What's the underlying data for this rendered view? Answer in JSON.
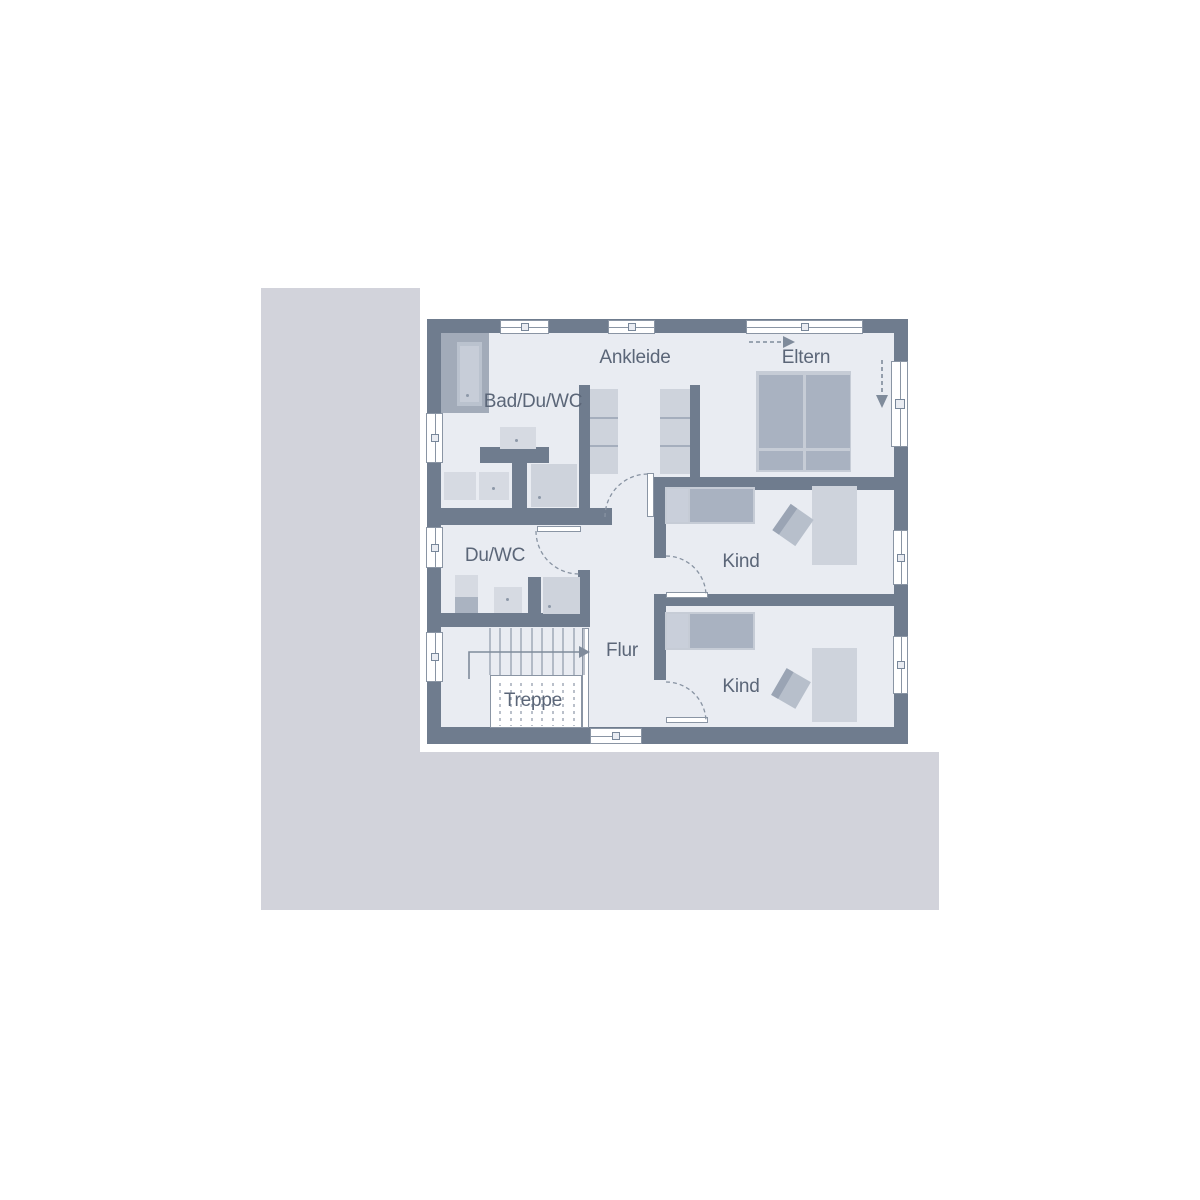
{
  "floor_plan": {
    "rooms": [
      {
        "label": "Ankleide"
      },
      {
        "label": "Eltern"
      },
      {
        "label": "Bad/Du/WC"
      },
      {
        "label": "Du/WC"
      },
      {
        "label": "Kind"
      },
      {
        "label": "Kind"
      },
      {
        "label": "Flur"
      },
      {
        "label": "Treppe"
      }
    ]
  },
  "colors": {
    "background": "#ffffff",
    "terrain": "#d2d3db",
    "floor": "#e9ecf2",
    "wall": "#6f7c8e",
    "furniture_medium": "#a9b2c1",
    "furniture_light": "#ced3dc",
    "fixture_light": "#d6dae2",
    "line": "#8a95a4",
    "text": "#5b6678",
    "arrow": "#7f8b9b"
  }
}
